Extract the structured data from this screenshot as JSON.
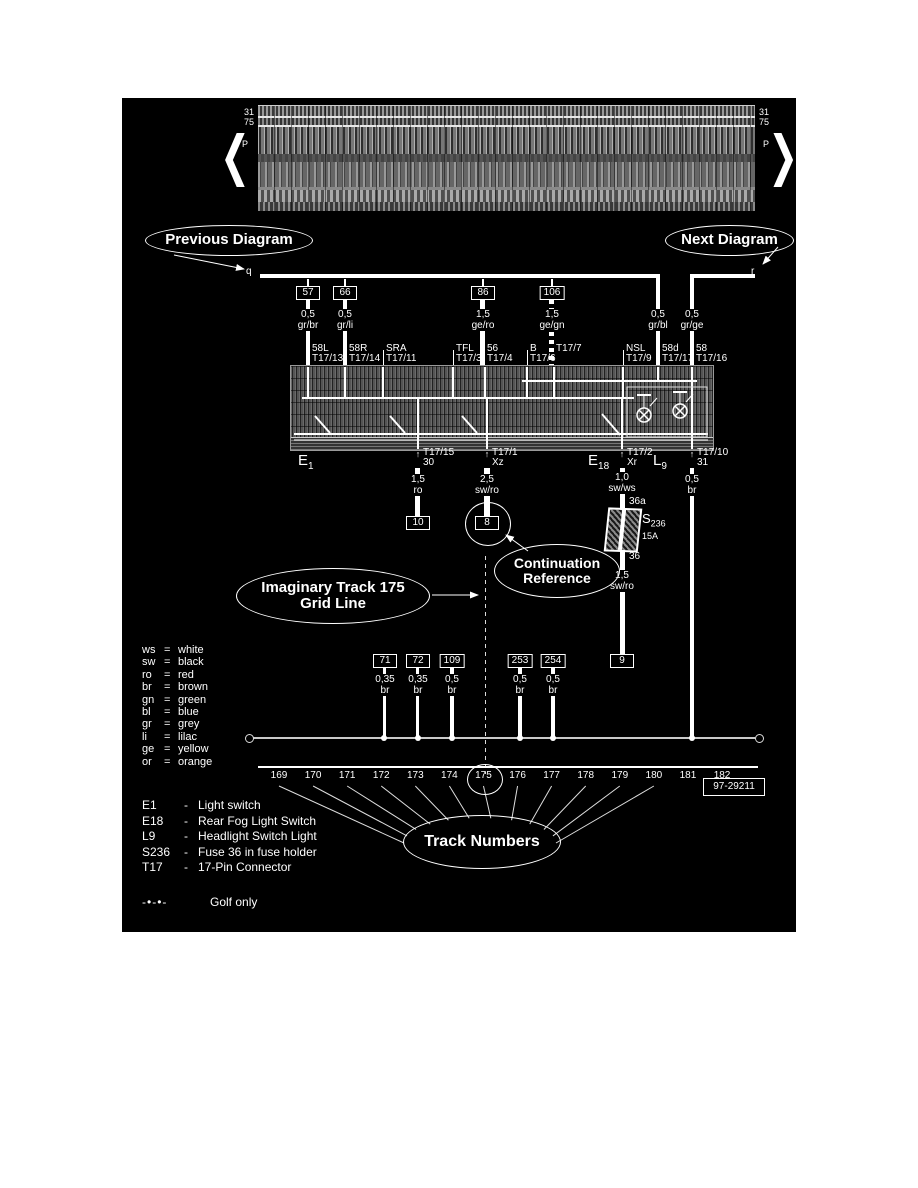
{
  "top_band": {
    "left_31": "31",
    "left_75": "75",
    "left_p": "P",
    "right_31": "31",
    "right_75": "75",
    "right_p": "P"
  },
  "icons": {
    "up_arrow": "↑",
    "down_arrow": "↓",
    "left_chevron": "❮",
    "right_chevron": "❯"
  },
  "callouts": {
    "previous_diagram": "Previous Diagram",
    "next_diagram": "Next Diagram",
    "continuation_line1": "Continuation",
    "continuation_line2": "Reference",
    "imaginary_line1": "Imaginary Track 175",
    "imaginary_line2": "Grid Line",
    "track_numbers": "Track Numbers"
  },
  "bus_markers": {
    "left": "q",
    "right": "r"
  },
  "top_wires": [
    {
      "ref": "57",
      "size": "0,5",
      "color": "gr/br"
    },
    {
      "ref": "66",
      "size": "0,5",
      "color": "gr/li"
    },
    {
      "ref": "86",
      "size": "1,5",
      "color": "ge/ro"
    },
    {
      "ref": "106",
      "size": "1,5",
      "color": "ge/gn"
    },
    {
      "ref": "",
      "size": "0,5",
      "color": "gr/bl"
    },
    {
      "ref": "",
      "size": "0,5",
      "color": "gr/ge"
    }
  ],
  "top_terminals": [
    {
      "name": "58L",
      "pin": "T17/13"
    },
    {
      "name": "58R",
      "pin": "T17/14"
    },
    {
      "name": "SRA",
      "pin": "T17/11"
    },
    {
      "name": "TFL",
      "pin": "T17/3"
    },
    {
      "name": "56",
      "pin": "T17/4"
    },
    {
      "name": "B",
      "pin": "T17/6"
    },
    {
      "name": "",
      "pin": "T17/7"
    },
    {
      "name": "NSL",
      "pin": "T17/9"
    },
    {
      "name": "58d",
      "pin": "T17/17"
    },
    {
      "name": "58",
      "pin": "T17/16"
    }
  ],
  "component_labels": [
    {
      "main": "E",
      "sub": "1"
    },
    {
      "main": "E",
      "sub": "18"
    },
    {
      "main": "L",
      "sub": "9"
    }
  ],
  "bottom_terminals": [
    {
      "name": "T17/15",
      "pin": "30"
    },
    {
      "name": "T17/1",
      "pin": "Xz"
    },
    {
      "name": "T17/2",
      "pin": "Xr"
    },
    {
      "name": "T17/10",
      "pin": "31"
    }
  ],
  "lower_wires": [
    {
      "size": "1,5",
      "color": "ro",
      "ref": "10"
    },
    {
      "size": "2,5",
      "color": "sw/ro",
      "ref": "8"
    },
    {
      "size": "1,0",
      "color": "sw/ws"
    },
    {
      "size": "1,5",
      "color": "sw/ro",
      "ref": "9"
    },
    {
      "size": "0,5",
      "color": "br"
    }
  ],
  "fuse": {
    "main": "S",
    "sub": "236",
    "amp": "15A",
    "top_pin": "36a",
    "bottom_pin": "36"
  },
  "ground_wires": [
    {
      "ref": "71",
      "size": "0,35",
      "color": "br"
    },
    {
      "ref": "72",
      "size": "0,35",
      "color": "br"
    },
    {
      "ref": "109",
      "size": "0,5",
      "color": "br"
    },
    {
      "ref": "253",
      "size": "0,5",
      "color": "br"
    },
    {
      "ref": "254",
      "size": "0,5",
      "color": "br"
    }
  ],
  "color_legend": {
    "eq": "=",
    "rows": [
      {
        "code": "ws",
        "name": "white"
      },
      {
        "code": "sw",
        "name": "black"
      },
      {
        "code": "ro",
        "name": "red"
      },
      {
        "code": "br",
        "name": "brown"
      },
      {
        "code": "gn",
        "name": "green"
      },
      {
        "code": "bl",
        "name": "blue"
      },
      {
        "code": "gr",
        "name": "grey"
      },
      {
        "code": "li",
        "name": "lilac"
      },
      {
        "code": "ge",
        "name": "yellow"
      },
      {
        "code": "or",
        "name": "orange"
      }
    ]
  },
  "tracks": {
    "numbers": [
      "169",
      "170",
      "171",
      "172",
      "173",
      "174",
      "175",
      "176",
      "177",
      "178",
      "179",
      "180",
      "181",
      "182"
    ],
    "highlighted": "175",
    "part_number": "97-29211"
  },
  "component_legend": {
    "sep": "-",
    "rows": [
      {
        "id": "E1",
        "desc": "Light switch"
      },
      {
        "id": "E18",
        "desc": "Rear Fog Light Switch"
      },
      {
        "id": "L9",
        "desc": "Headlight Switch Light"
      },
      {
        "id": "S236",
        "desc": "Fuse 36 in fuse holder"
      },
      {
        "id": "T17",
        "desc": "17-Pin Connector"
      }
    ]
  },
  "golf_note": {
    "symbol": "-•-•-",
    "text": "Golf only"
  }
}
